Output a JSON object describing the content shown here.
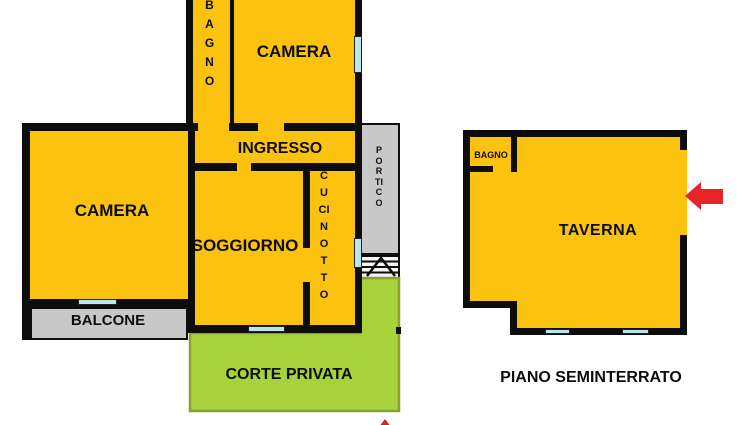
{
  "plan": {
    "upper": {
      "bagno": "BAGNO",
      "camera_top": "CAMERA",
      "ingresso": "INGRESSO",
      "camera_left": "CAMERA",
      "soggiorno": "SOGGIORNO",
      "cucinotto": "CUCINOTTO",
      "balcone": "BALCONE",
      "portico": "PORTICO",
      "corte_privata": "CORTE PRIVATA"
    },
    "basement": {
      "bagno": "BAGNO",
      "taverna": "TAVERNA",
      "caption": "PIANO SEMINTERRATO"
    },
    "icons": {
      "entrance_arrow": "left-arrow",
      "bottom_marker": "up-arrow-tip",
      "stairs": "stair-treads",
      "windows": "window-markers"
    },
    "colors": {
      "room_yellow": "#FBC30F",
      "outdoor_gray": "#C8C8C8",
      "court_green": "#A8D23C",
      "court_border": "#8E9E2F",
      "window_cyan": "#B8E6EA",
      "arrow_red": "#E52528",
      "wall_black": "#0D0D0D"
    }
  }
}
